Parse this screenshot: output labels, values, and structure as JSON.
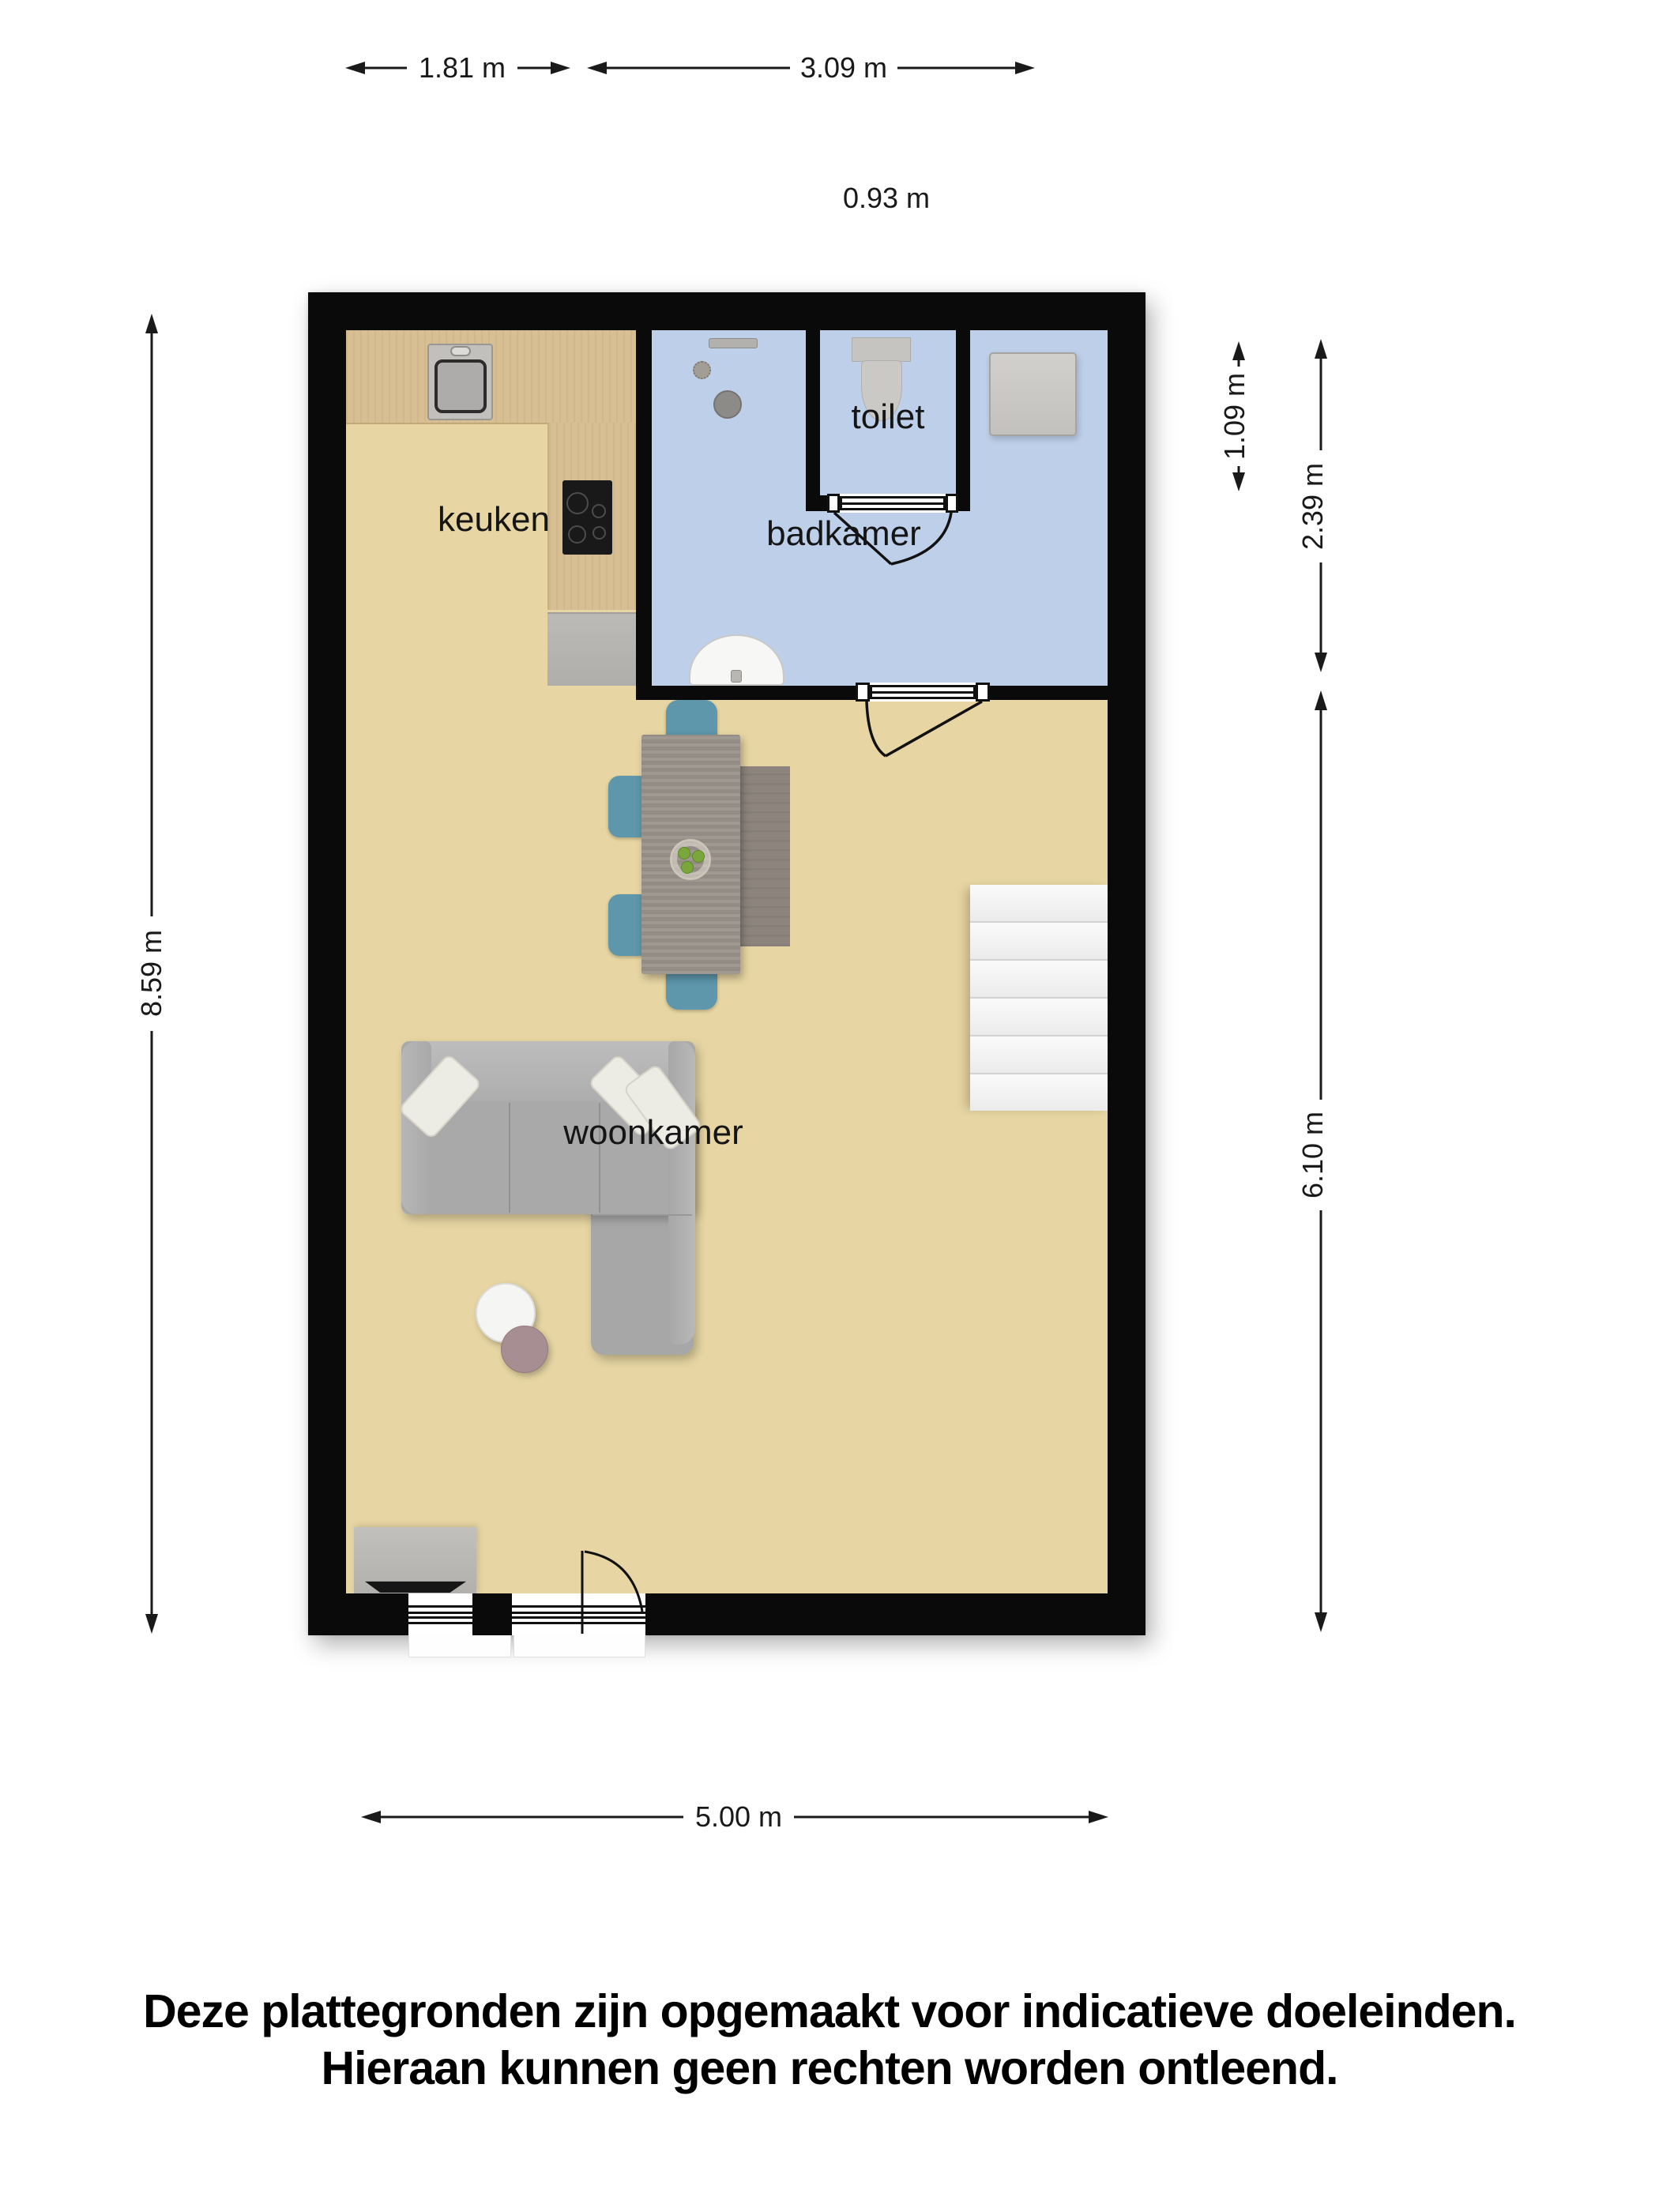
{
  "plan": {
    "rooms": {
      "kitchen_label": "keuken",
      "toilet_label": "toilet",
      "bathroom_label": "badkamer",
      "living_room_label": "woonkamer"
    },
    "colors": {
      "wall": "#0a0a0a",
      "living_floor": "#e7d6a3",
      "bathroom_floor": "#bdcfe9",
      "counter_wood": "#d8bf93",
      "chair_teal": "#5e96ab",
      "sofa_gray": "#aaaaaa",
      "table_gray_wood": "#99928a",
      "stairs_white": "#f3f3f3",
      "dimension_ink": "#1a1a1a"
    }
  },
  "dimensions": {
    "top_width_left": "1.81 m",
    "top_width_right": "3.09 m",
    "top_offset": "0.93 m",
    "left_total_height": "8.59 m",
    "right_toilet_depth": "1.09 m",
    "right_bathroom_height": "2.39 m",
    "right_living_height": "6.10 m",
    "bottom_width": "5.00 m"
  },
  "disclaimer": {
    "line1": "Deze plattegronden zijn opgemaakt voor indicatieve doeleinden.",
    "line2": "Hieraan kunnen geen rechten worden ontleend."
  }
}
